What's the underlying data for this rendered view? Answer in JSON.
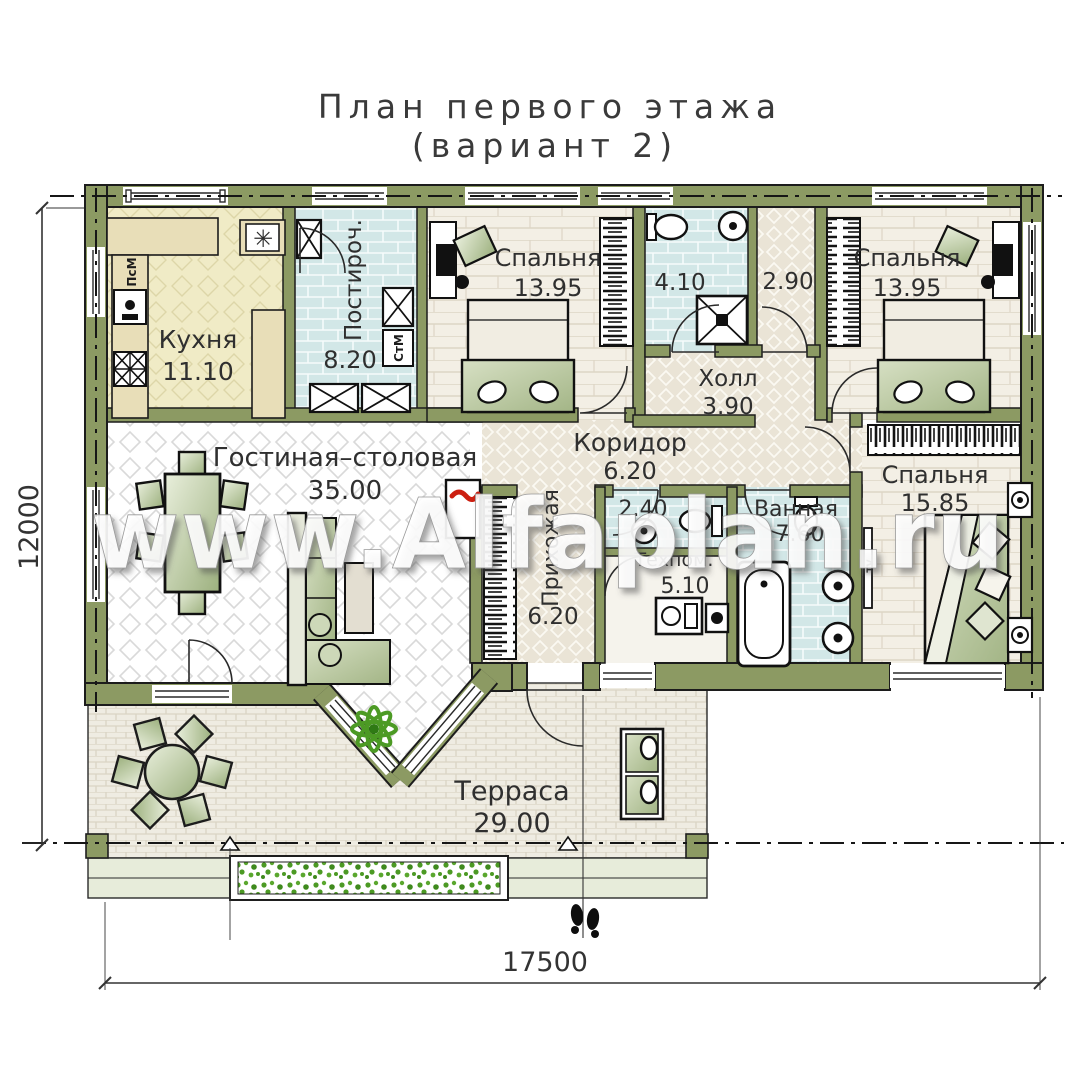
{
  "title": {
    "line1": "План первого этажа",
    "line2": "(вариант 2)"
  },
  "watermark": "www.Alfaplan.ru",
  "dimensions": {
    "bottom": "17500",
    "left": "12000"
  },
  "rooms": {
    "kitchen": {
      "name": "Кухня",
      "area": "11.10"
    },
    "laundry": {
      "name": "Постироч.",
      "area": "8.20"
    },
    "bedroom1": {
      "name": "Спальня",
      "area": "13.95"
    },
    "bathroom1": {
      "name": "",
      "area": "4.10"
    },
    "closet": {
      "name": "",
      "area": "2.90"
    },
    "bedroom2": {
      "name": "Спальня",
      "area": "13.95"
    },
    "hall": {
      "name": "Холл",
      "area": "3.90"
    },
    "corridor": {
      "name": "Коридор",
      "area": "6.20"
    },
    "living": {
      "name": "Гостиная–столовая",
      "area": "35.00"
    },
    "entry": {
      "name": "Прихожая",
      "area": "6.20"
    },
    "wc": {
      "name": "",
      "area": "2.40"
    },
    "tech": {
      "name": "Техпом.",
      "area": "5.10"
    },
    "bath": {
      "name": "Ванная",
      "area": "7.60"
    },
    "bedroom3": {
      "name": "Спальня",
      "area": "15.85"
    },
    "terrace": {
      "name": "Терраса",
      "area": "29.00"
    }
  },
  "appliances": {
    "dishwasher": "ПсМ",
    "washer": "СтМ",
    "tv": "TV",
    "hob": "✳"
  },
  "colors": {
    "wall": "#8C9A63",
    "floor_beige": "#EAE4D6",
    "floor_plank": "#F3EFE5",
    "floor_blue": "#D2E7E7",
    "floor_yellow": "#F0EBC6",
    "terrace_paver": "#EFECE2",
    "furniture_green": "#A9BC8B",
    "plant_green": "#4C9A24"
  }
}
